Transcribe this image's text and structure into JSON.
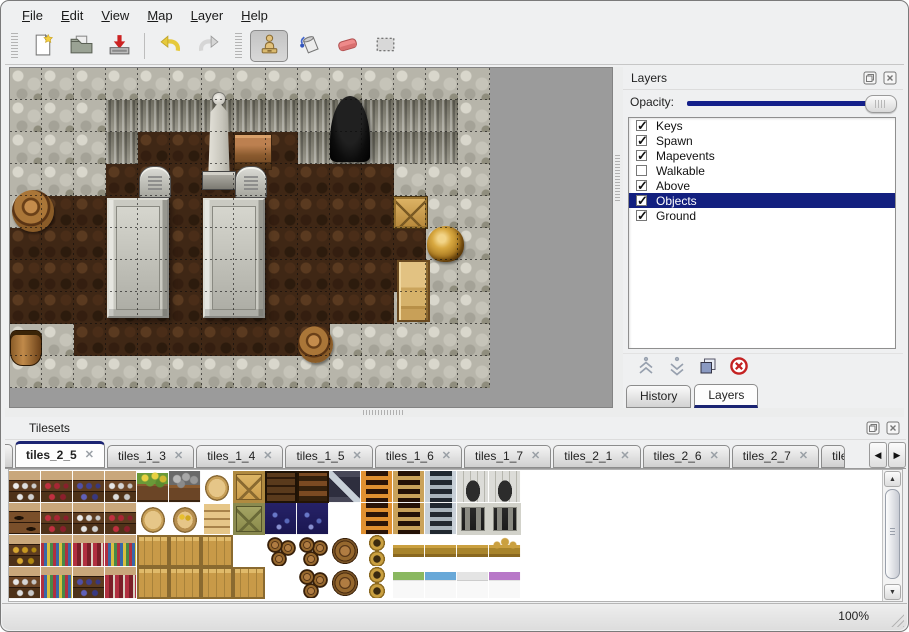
{
  "menu": {
    "items": [
      {
        "label": "File"
      },
      {
        "label": "Edit"
      },
      {
        "label": "View"
      },
      {
        "label": "Map"
      },
      {
        "label": "Layer"
      },
      {
        "label": "Help"
      }
    ]
  },
  "toolbar": {
    "buttons": [
      "new-file",
      "open",
      "save",
      "undo",
      "redo"
    ],
    "tools": [
      "stamp",
      "fill",
      "eraser",
      "select-rect"
    ],
    "active_tool": "stamp"
  },
  "map": {
    "tile_size": 32,
    "grid": [
      "WWWWWWWWWWWWWWW",
      "WWWCCCCCCCCCCCW",
      "WWWCFFFFFCCCCCW",
      "WWWFFFFFFFFFWWW",
      "WFFFFFFFFFFFFWW",
      "FFFFFFFFFFFFFWW",
      "FFFFFFFFFFFFFWW",
      "FFFFFFFFFFFFWWW",
      "WWFFFFFFFFWWWWW",
      "WWWWWWWWWWWWWWW"
    ],
    "objects": [
      {
        "type": "cave",
        "x": 320,
        "y": 28,
        "w": 40,
        "h": 66
      },
      {
        "type": "statue",
        "x": 192,
        "y": 24,
        "w": 34,
        "h": 98
      },
      {
        "type": "table",
        "x": 224,
        "y": 66,
        "w": 36,
        "h": 34
      },
      {
        "type": "grave",
        "x": 129,
        "y": 98,
        "w": 30,
        "h": 30
      },
      {
        "type": "grave",
        "x": 225,
        "y": 98,
        "w": 30,
        "h": 30
      },
      {
        "type": "slab",
        "x": 97,
        "y": 130,
        "w": 62,
        "h": 120
      },
      {
        "type": "slab",
        "x": 193,
        "y": 130,
        "w": 62,
        "h": 120
      },
      {
        "type": "barrel",
        "x": 2,
        "y": 122,
        "w": 42,
        "h": 42
      },
      {
        "type": "crate",
        "x": 383,
        "y": 128,
        "w": 35,
        "h": 33
      },
      {
        "type": "vase",
        "x": 417,
        "y": 158,
        "w": 37,
        "h": 36
      },
      {
        "type": "cabinet",
        "x": 387,
        "y": 192,
        "w": 33,
        "h": 62
      },
      {
        "type": "barrel",
        "x": 288,
        "y": 258,
        "w": 35,
        "h": 37
      },
      {
        "type": "bucket",
        "x": 0,
        "y": 262,
        "w": 30,
        "h": 34
      }
    ]
  },
  "layers_panel": {
    "title": "Layers",
    "opacity_label": "Opacity:",
    "opacity_fraction": 1.0,
    "layers": [
      {
        "label": "Keys",
        "checked": true,
        "selected": false
      },
      {
        "label": "Spawn",
        "checked": true,
        "selected": false
      },
      {
        "label": "Mapevents",
        "checked": true,
        "selected": false
      },
      {
        "label": "Walkable",
        "checked": false,
        "selected": false
      },
      {
        "label": "Above",
        "checked": true,
        "selected": false
      },
      {
        "label": "Objects",
        "checked": true,
        "selected": true
      },
      {
        "label": "Ground",
        "checked": true,
        "selected": false
      }
    ],
    "buttons": [
      "raise-layer",
      "lower-layer",
      "duplicate-layer",
      "delete-layer"
    ],
    "tabs": [
      {
        "label": "History",
        "active": false
      },
      {
        "label": "Layers",
        "active": true
      }
    ]
  },
  "tilesets_panel": {
    "title": "Tilesets",
    "tabs": [
      {
        "label": "tiles_2_5",
        "active": true,
        "partial": false
      },
      {
        "label": "tiles_1_3",
        "active": false,
        "partial": false
      },
      {
        "label": "tiles_1_4",
        "active": false,
        "partial": false
      },
      {
        "label": "tiles_1_5",
        "active": false,
        "partial": false
      },
      {
        "label": "tiles_1_6",
        "active": false,
        "partial": false
      },
      {
        "label": "tiles_1_7",
        "active": false,
        "partial": false
      },
      {
        "label": "tiles_2_1",
        "active": false,
        "partial": false
      },
      {
        "label": "tiles_2_6",
        "active": false,
        "partial": false
      },
      {
        "label": "tiles_2_7",
        "active": false,
        "partial": false
      },
      {
        "label": "tiles_2",
        "active": false,
        "partial": true
      }
    ],
    "palette": [
      [
        "shelfA",
        "shelfB",
        "shelfC",
        "shelfD",
        "flower",
        "rocks",
        "sack",
        "crateX",
        "crateD",
        "stripes",
        "ztile",
        "ladO",
        "ladB",
        "ladG",
        "arch",
        "arch",
        "empty"
      ],
      [
        "shelfE",
        "shelfB",
        "shelfA",
        "shelfB",
        "sack",
        "sackO",
        "sacks",
        "crateXd",
        "navy",
        "navy",
        "empty",
        "ladO",
        "ladB",
        "ladG",
        "gate",
        "gate",
        "empty"
      ],
      [
        "shelfH",
        "shelfF",
        "shelfG",
        "shelfF",
        "crate",
        "crate",
        "crate",
        "empty",
        "barrels",
        "barrels",
        "barrel1",
        "pots",
        "bedH",
        "bedH",
        "bedH",
        "bedC",
        "empty"
      ],
      [
        "shelfD",
        "shelfF",
        "shelfC",
        "shelfG",
        "crate",
        "crate",
        "crate",
        "crate",
        "empty",
        "barrels",
        "barrel1",
        "pots",
        "bedG",
        "bedB",
        "bedW",
        "bedP",
        "empty"
      ]
    ]
  },
  "status": {
    "zoom_label": "100%"
  },
  "icons": {
    "check": "✓",
    "close_tab": "✕",
    "scroll_left": "◀",
    "scroll_right": "▶",
    "scroll_up": "▲",
    "scroll_down": "▼"
  },
  "colors": {
    "selection_navy": "#13207f",
    "slider_navy": "#14208a",
    "tab_accent_navy": "#1b2473",
    "canvas_gray": "#9b9b9b"
  }
}
